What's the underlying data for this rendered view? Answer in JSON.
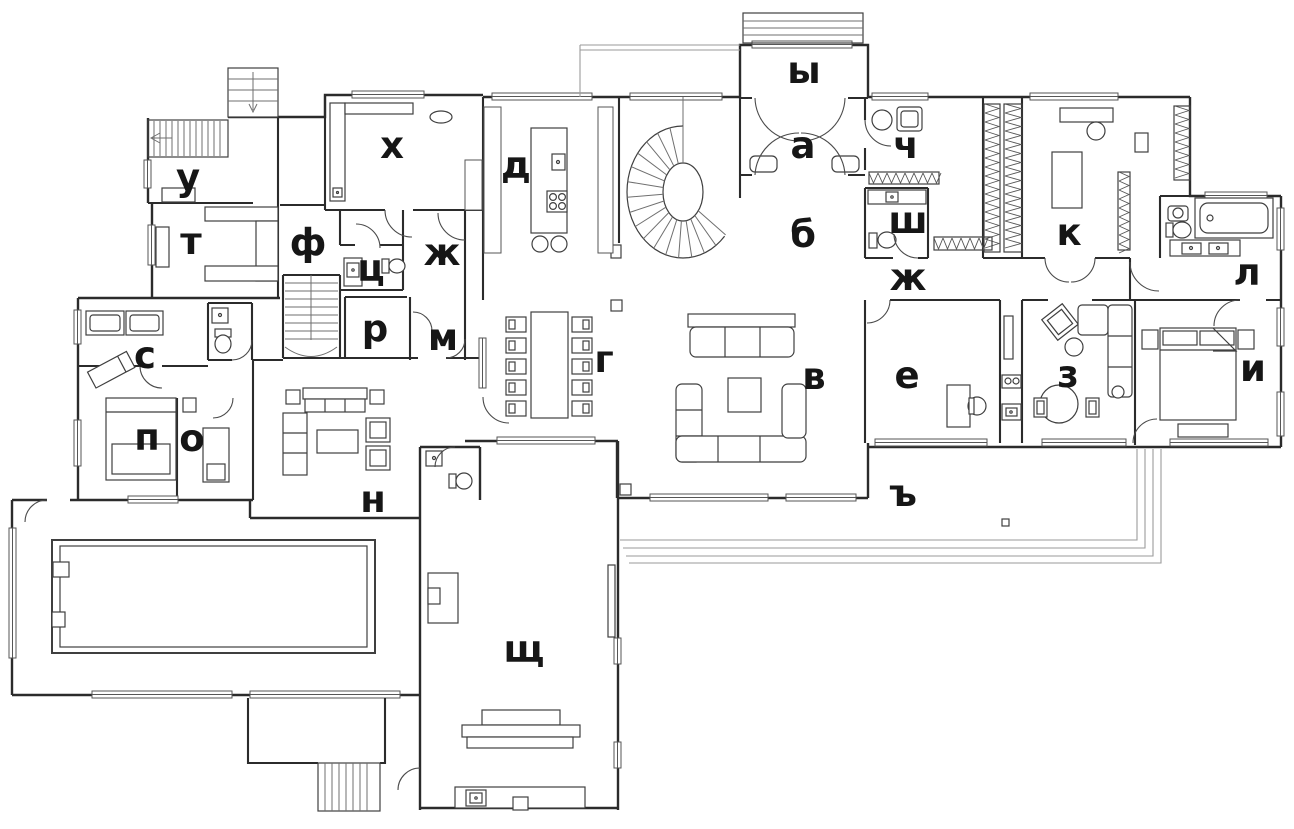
{
  "plan": {
    "type": "floor-plan",
    "palette": {
      "wall": "#2b2b2b",
      "furniture": "#3f3f3f",
      "label": "#161616",
      "background": "#ffffff",
      "terrace_line": "#9a9a9a"
    }
  },
  "rooms": [
    {
      "id": "u",
      "char": "у",
      "x": 188,
      "y": 190
    },
    {
      "id": "t",
      "char": "т",
      "x": 191,
      "y": 254
    },
    {
      "id": "f",
      "char": "ф",
      "x": 308,
      "y": 255
    },
    {
      "id": "kh",
      "char": "х",
      "x": 392,
      "y": 158
    },
    {
      "id": "ts",
      "char": "ц",
      "x": 371,
      "y": 281
    },
    {
      "id": "zh-west",
      "char": "ж",
      "x": 442,
      "y": 265
    },
    {
      "id": "d",
      "char": "д",
      "x": 516,
      "y": 178
    },
    {
      "id": "y",
      "char": "ы",
      "x": 804,
      "y": 83
    },
    {
      "id": "a",
      "char": "а",
      "x": 803,
      "y": 158
    },
    {
      "id": "b",
      "char": "б",
      "x": 803,
      "y": 247
    },
    {
      "id": "ch",
      "char": "ч",
      "x": 906,
      "y": 158
    },
    {
      "id": "sh",
      "char": "ш",
      "x": 908,
      "y": 233
    },
    {
      "id": "zh-east",
      "char": "ж",
      "x": 908,
      "y": 290
    },
    {
      "id": "k",
      "char": "к",
      "x": 1069,
      "y": 245
    },
    {
      "id": "l",
      "char": "л",
      "x": 1247,
      "y": 285
    },
    {
      "id": "i",
      "char": "и",
      "x": 1253,
      "y": 381
    },
    {
      "id": "z",
      "char": "з",
      "x": 1068,
      "y": 387
    },
    {
      "id": "e",
      "char": "е",
      "x": 907,
      "y": 388
    },
    {
      "id": "v",
      "char": "в",
      "x": 814,
      "y": 389
    },
    {
      "id": "g",
      "char": "г",
      "x": 604,
      "y": 372
    },
    {
      "id": "m",
      "char": "м",
      "x": 443,
      "y": 350
    },
    {
      "id": "r",
      "char": "р",
      "x": 375,
      "y": 341
    },
    {
      "id": "s",
      "char": "с",
      "x": 145,
      "y": 368
    },
    {
      "id": "p",
      "char": "п",
      "x": 147,
      "y": 450
    },
    {
      "id": "o",
      "char": "о",
      "x": 192,
      "y": 451
    },
    {
      "id": "n",
      "char": "н",
      "x": 373,
      "y": 512
    },
    {
      "id": "tvz",
      "char": "ъ",
      "x": 903,
      "y": 506
    },
    {
      "id": "shch",
      "char": "щ",
      "x": 524,
      "y": 662
    }
  ]
}
